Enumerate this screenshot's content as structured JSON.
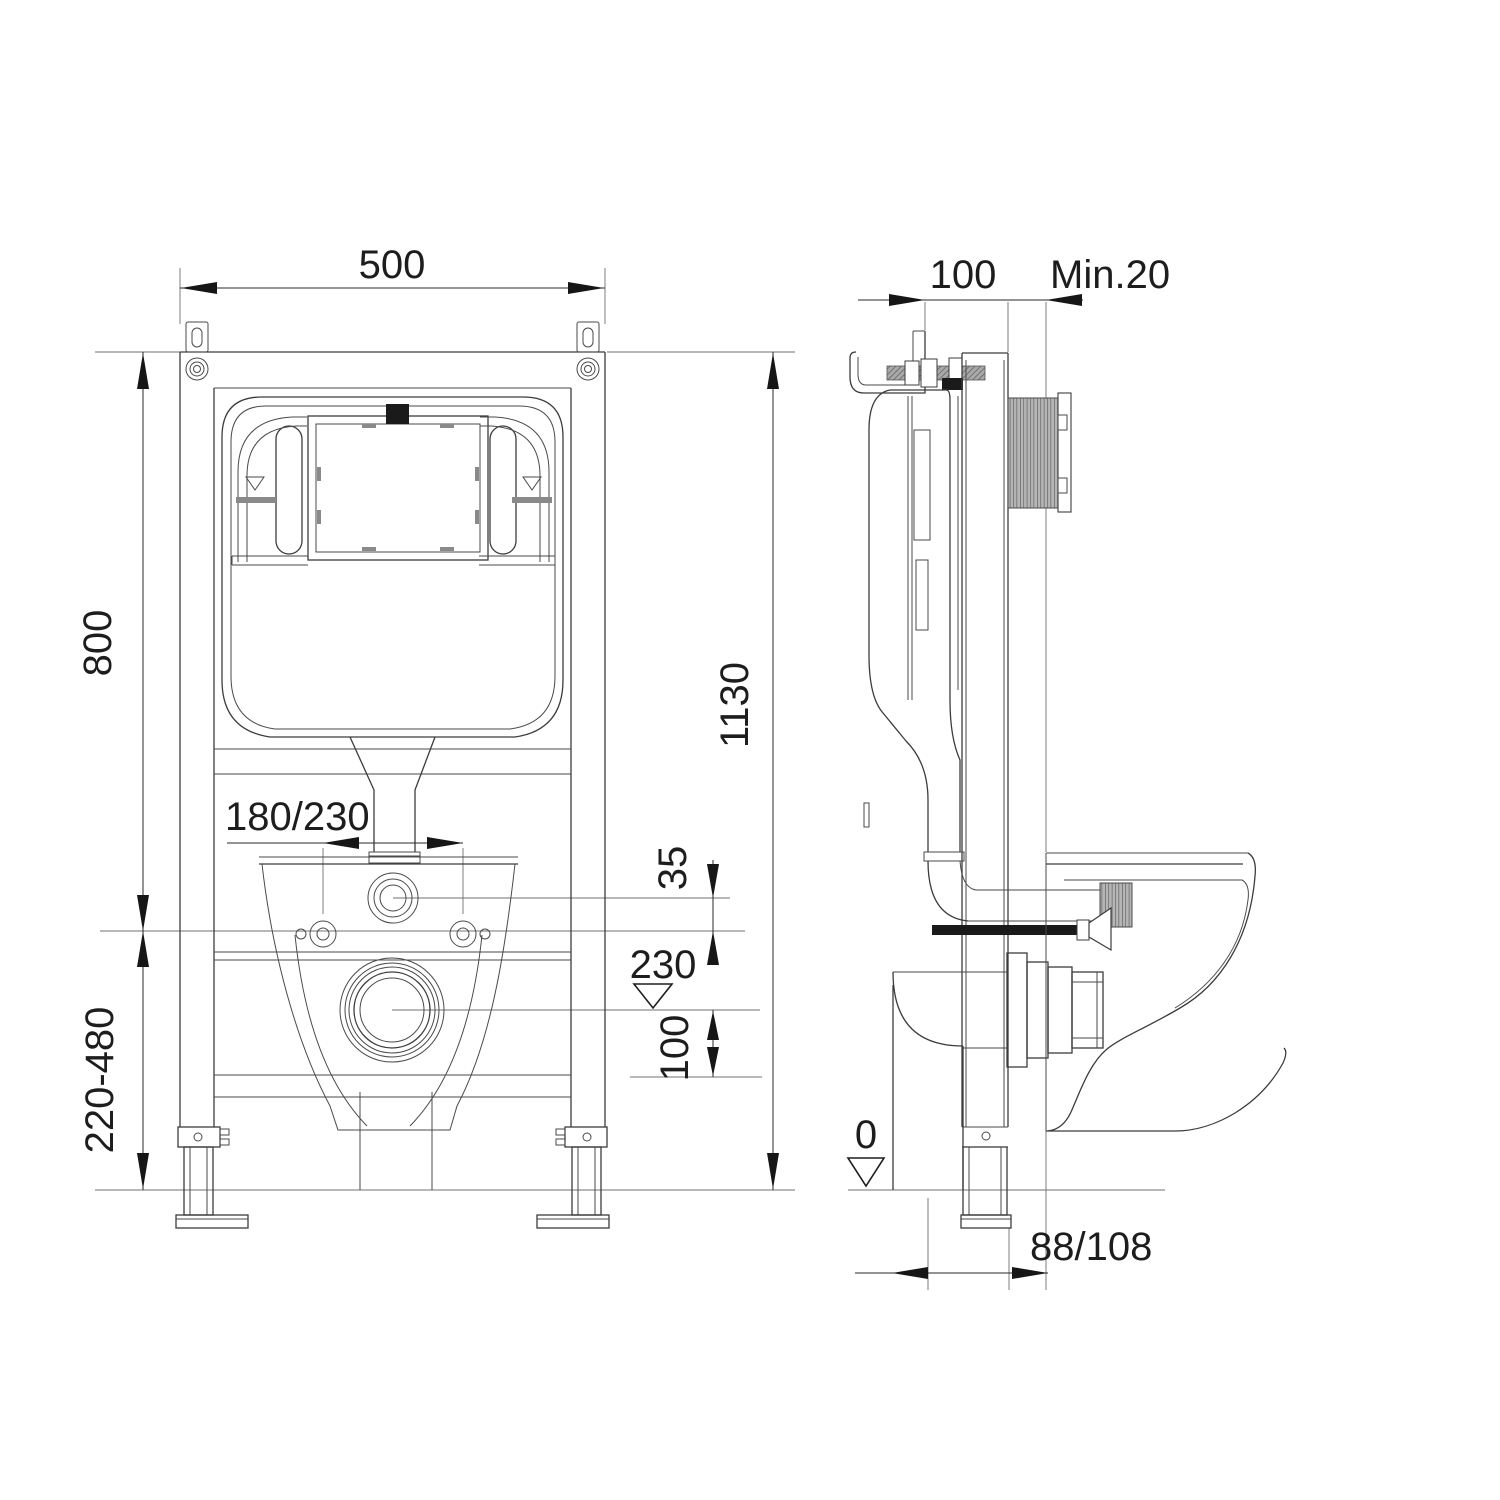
{
  "front_view": {
    "width": "500",
    "total_height": "1130",
    "upper_height": "800",
    "adjustable_range": "220-480",
    "fixing_spacing": "180/230",
    "inlet_offset": "35",
    "drain_level": "230",
    "drain_drop": "100"
  },
  "side_view": {
    "frame_depth": "100",
    "min_wall": "Min.20",
    "floor_level": "0",
    "outlet_offset": "88/108"
  }
}
